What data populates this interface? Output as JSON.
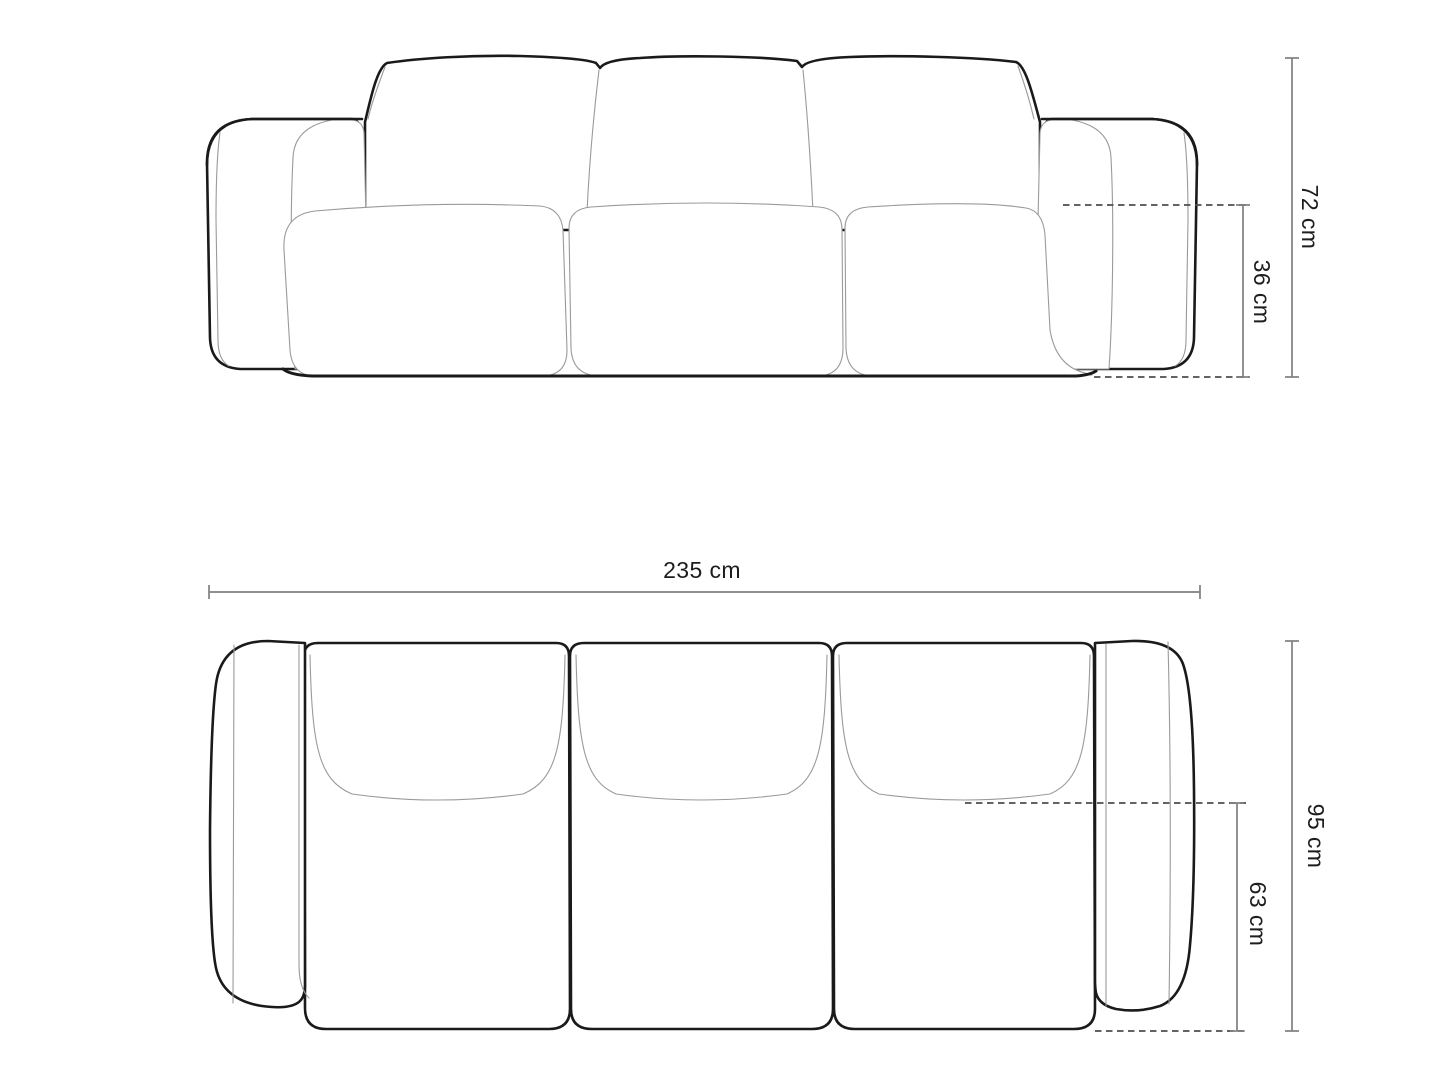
{
  "diagram": {
    "title": "sofa-dimension-diagram",
    "views": {
      "front": {
        "name": "front-view",
        "dimensions": {
          "total_height": {
            "value": 72,
            "unit": "cm",
            "label": "72 cm"
          },
          "seat_height": {
            "value": 36,
            "unit": "cm",
            "label": "36 cm"
          }
        }
      },
      "top": {
        "name": "top-view",
        "dimensions": {
          "total_width": {
            "value": 235,
            "unit": "cm",
            "label": "235 cm"
          },
          "total_depth": {
            "value": 95,
            "unit": "cm",
            "label": "95 cm"
          },
          "seat_depth": {
            "value": 63,
            "unit": "cm",
            "label": "63 cm"
          }
        }
      }
    },
    "colors": {
      "background": "#ffffff",
      "outline": "#1a1a1a",
      "seam": "#9a9a9a",
      "dimension_line": "#7f7f7f",
      "dashed_line": "#4d4d4d",
      "text": "#1d1d1d"
    }
  }
}
